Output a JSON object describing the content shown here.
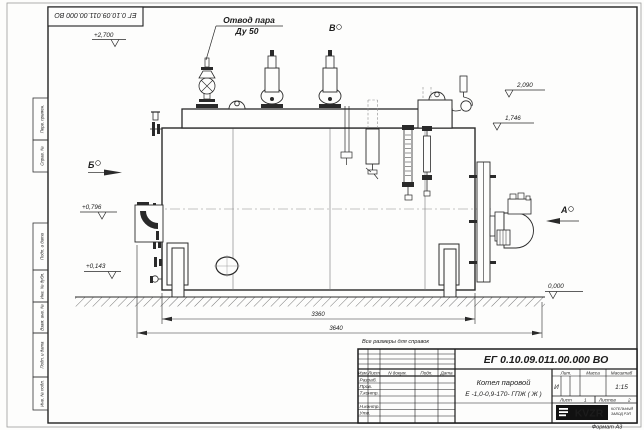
{
  "frame": {
    "stamp_doc_number": "ЕГ 0.10.09.011.00.000  ВО",
    "left_columns": [
      "Перв. примен.",
      "Справ. №",
      "Подп. и дата",
      "Инв. № дубл.",
      "Взам. инв. №",
      "Подп. и дата",
      "Инв. № подл."
    ]
  },
  "drawing": {
    "callout_line1": "Отвод пара",
    "callout_line2": "Ду 50",
    "view_markers": {
      "a": "А",
      "b": "Б",
      "v": "В"
    },
    "elevations": {
      "top": "+2,700",
      "upper_right": "2,090",
      "right": "1,746",
      "left_mid": "+0,796",
      "left_low": "+0,143",
      "ground": "0,000"
    },
    "dim_inner": "3360",
    "dim_outer": "3640",
    "note": "Все размеры для справок"
  },
  "title_block": {
    "doc_number": "ЕГ 0.10.09.011.00.000  ВО",
    "product_line1": "Котел паровой",
    "product_line2": "Е -1,0-0,9-170- ГПЖ ( Ж )",
    "header_cells": [
      "Изм.",
      "Лист",
      "N докум.",
      "Подп.",
      "Дата"
    ],
    "sign_rows": [
      "Разраб.",
      "Пров.",
      "Т.контр.",
      "Н.контр.",
      "Утв."
    ],
    "lit_label": "Лит.",
    "mass_label": "Масса",
    "scale_label": "Масштаб",
    "lit_value": "И",
    "scale_value": "1:15",
    "sheet_label": "Лист",
    "sheet_value": "1",
    "sheets_label": "Листов",
    "sheets_value": "2",
    "company_logo": "KVZR",
    "company_line1": "КОТЕЛЬНЫЙ",
    "company_line2": "ЗАВОД РЭП",
    "format_note": "Формат А3"
  }
}
